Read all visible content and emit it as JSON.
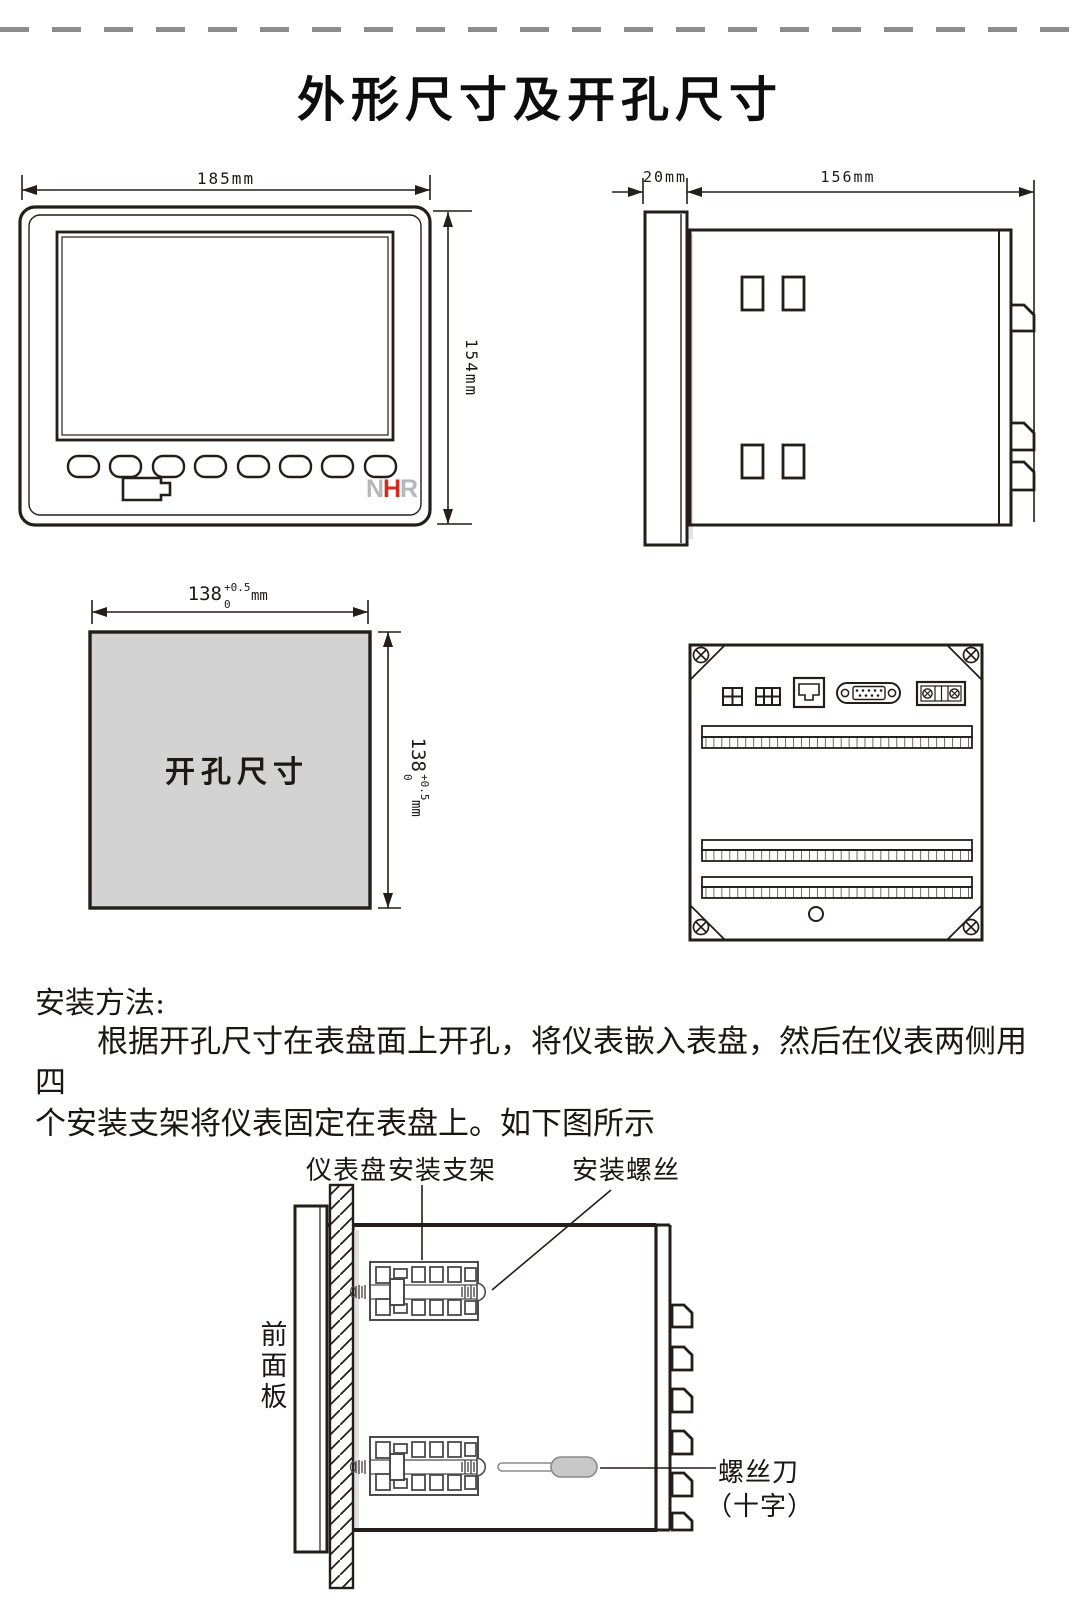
{
  "page": {
    "title": "外形尺寸及开孔尺寸",
    "heading": "安装方法:",
    "paragraph_lines": [
      "根据开孔尺寸在表盘面上开孔，将仪表嵌入表盘，然后在仪表两侧用四",
      "个安装支架将仪表固定在表盘上。如下图所示"
    ]
  },
  "front_view": {
    "width_label": "185mm",
    "height_label": "154mm",
    "logo": {
      "n": "N",
      "h": "H",
      "r": "R"
    }
  },
  "side_view": {
    "bezel_depth_label": "20mm",
    "body_depth_label": "156mm"
  },
  "cutout_view": {
    "area_label": "开孔尺寸",
    "width": {
      "value": "138",
      "tol_upper": "+0.5",
      "tol_lower": "0",
      "unit": "mm"
    },
    "height": {
      "value": "138",
      "tol_upper": "+0.5",
      "tol_lower": "0",
      "unit": "mm"
    }
  },
  "install_diagram": {
    "labels": {
      "panel": "仪表盘",
      "bracket": "安装支架",
      "screw": "安装螺丝",
      "front_panel": "前面板",
      "screwdriver": "螺丝刀",
      "screwdriver_type": "（十字）"
    }
  },
  "colors": {
    "line": "#241d19",
    "cutout_fill": "#d3d3d3",
    "logo_red": "#d22b1f",
    "logo_gray": "#b4b7bb",
    "dash_gray": "#8c8c8c"
  }
}
